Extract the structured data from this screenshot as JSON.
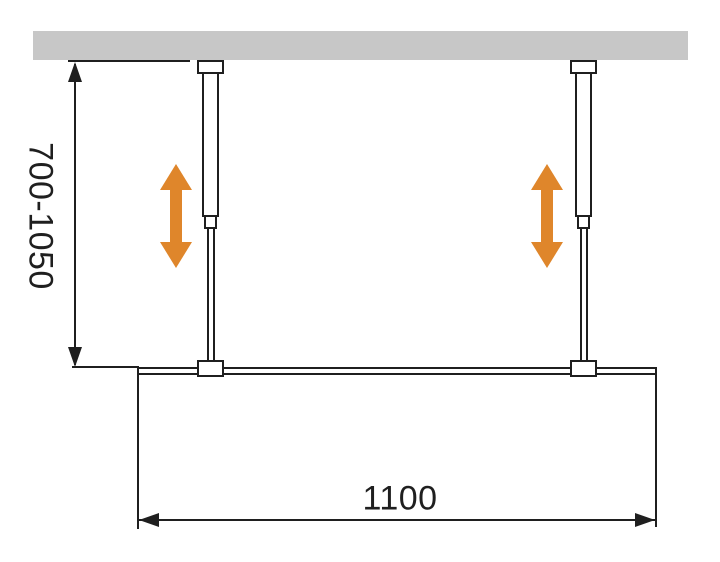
{
  "dimensions": {
    "height_range_label": "700-1050",
    "width_label": "1100"
  },
  "colors": {
    "accent_orange": "#DF862B",
    "ceiling_gray": "#C7C7C7",
    "line_black": "#1F1F1F"
  },
  "icons": {
    "left_adjust_arrow": "double-headed-vertical-arrow",
    "right_adjust_arrow": "double-headed-vertical-arrow"
  }
}
